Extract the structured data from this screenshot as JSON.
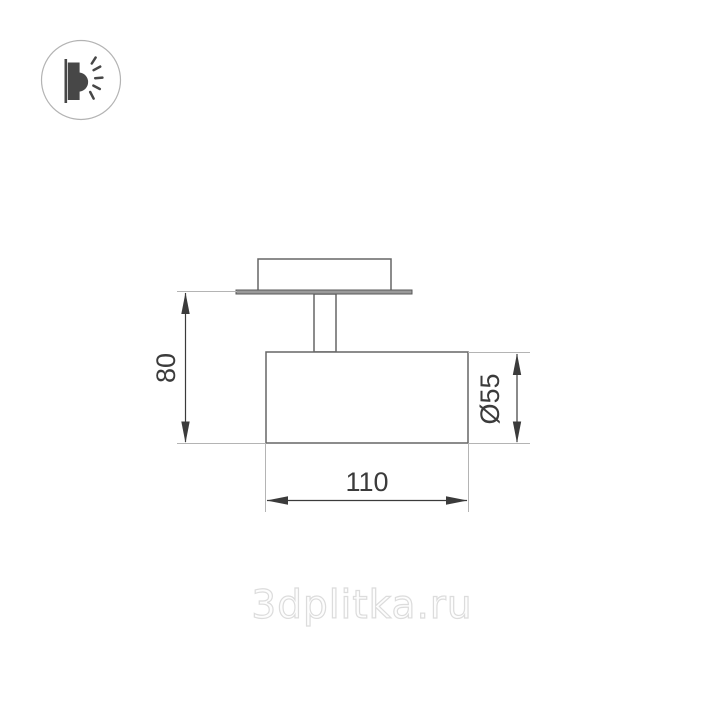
{
  "drawing": {
    "type": "technical-dimension-drawing",
    "dimensions": {
      "height": "80",
      "diameter": "Ø55",
      "width": "110"
    }
  },
  "logo": {
    "icon": "wall-lamp-light-icon"
  },
  "watermark": {
    "text": "3dplitka.ru"
  },
  "colors": {
    "background": "#ffffff",
    "fixture_outline": "#666666",
    "plate_fill": "#9a9a9a",
    "dimension_line": "#3b3b3b",
    "extension_line": "#b4b4b4",
    "logo_glyph": "#474747",
    "logo_circle": "#b3b3b3",
    "watermark_outline": "#dcdcdc"
  }
}
